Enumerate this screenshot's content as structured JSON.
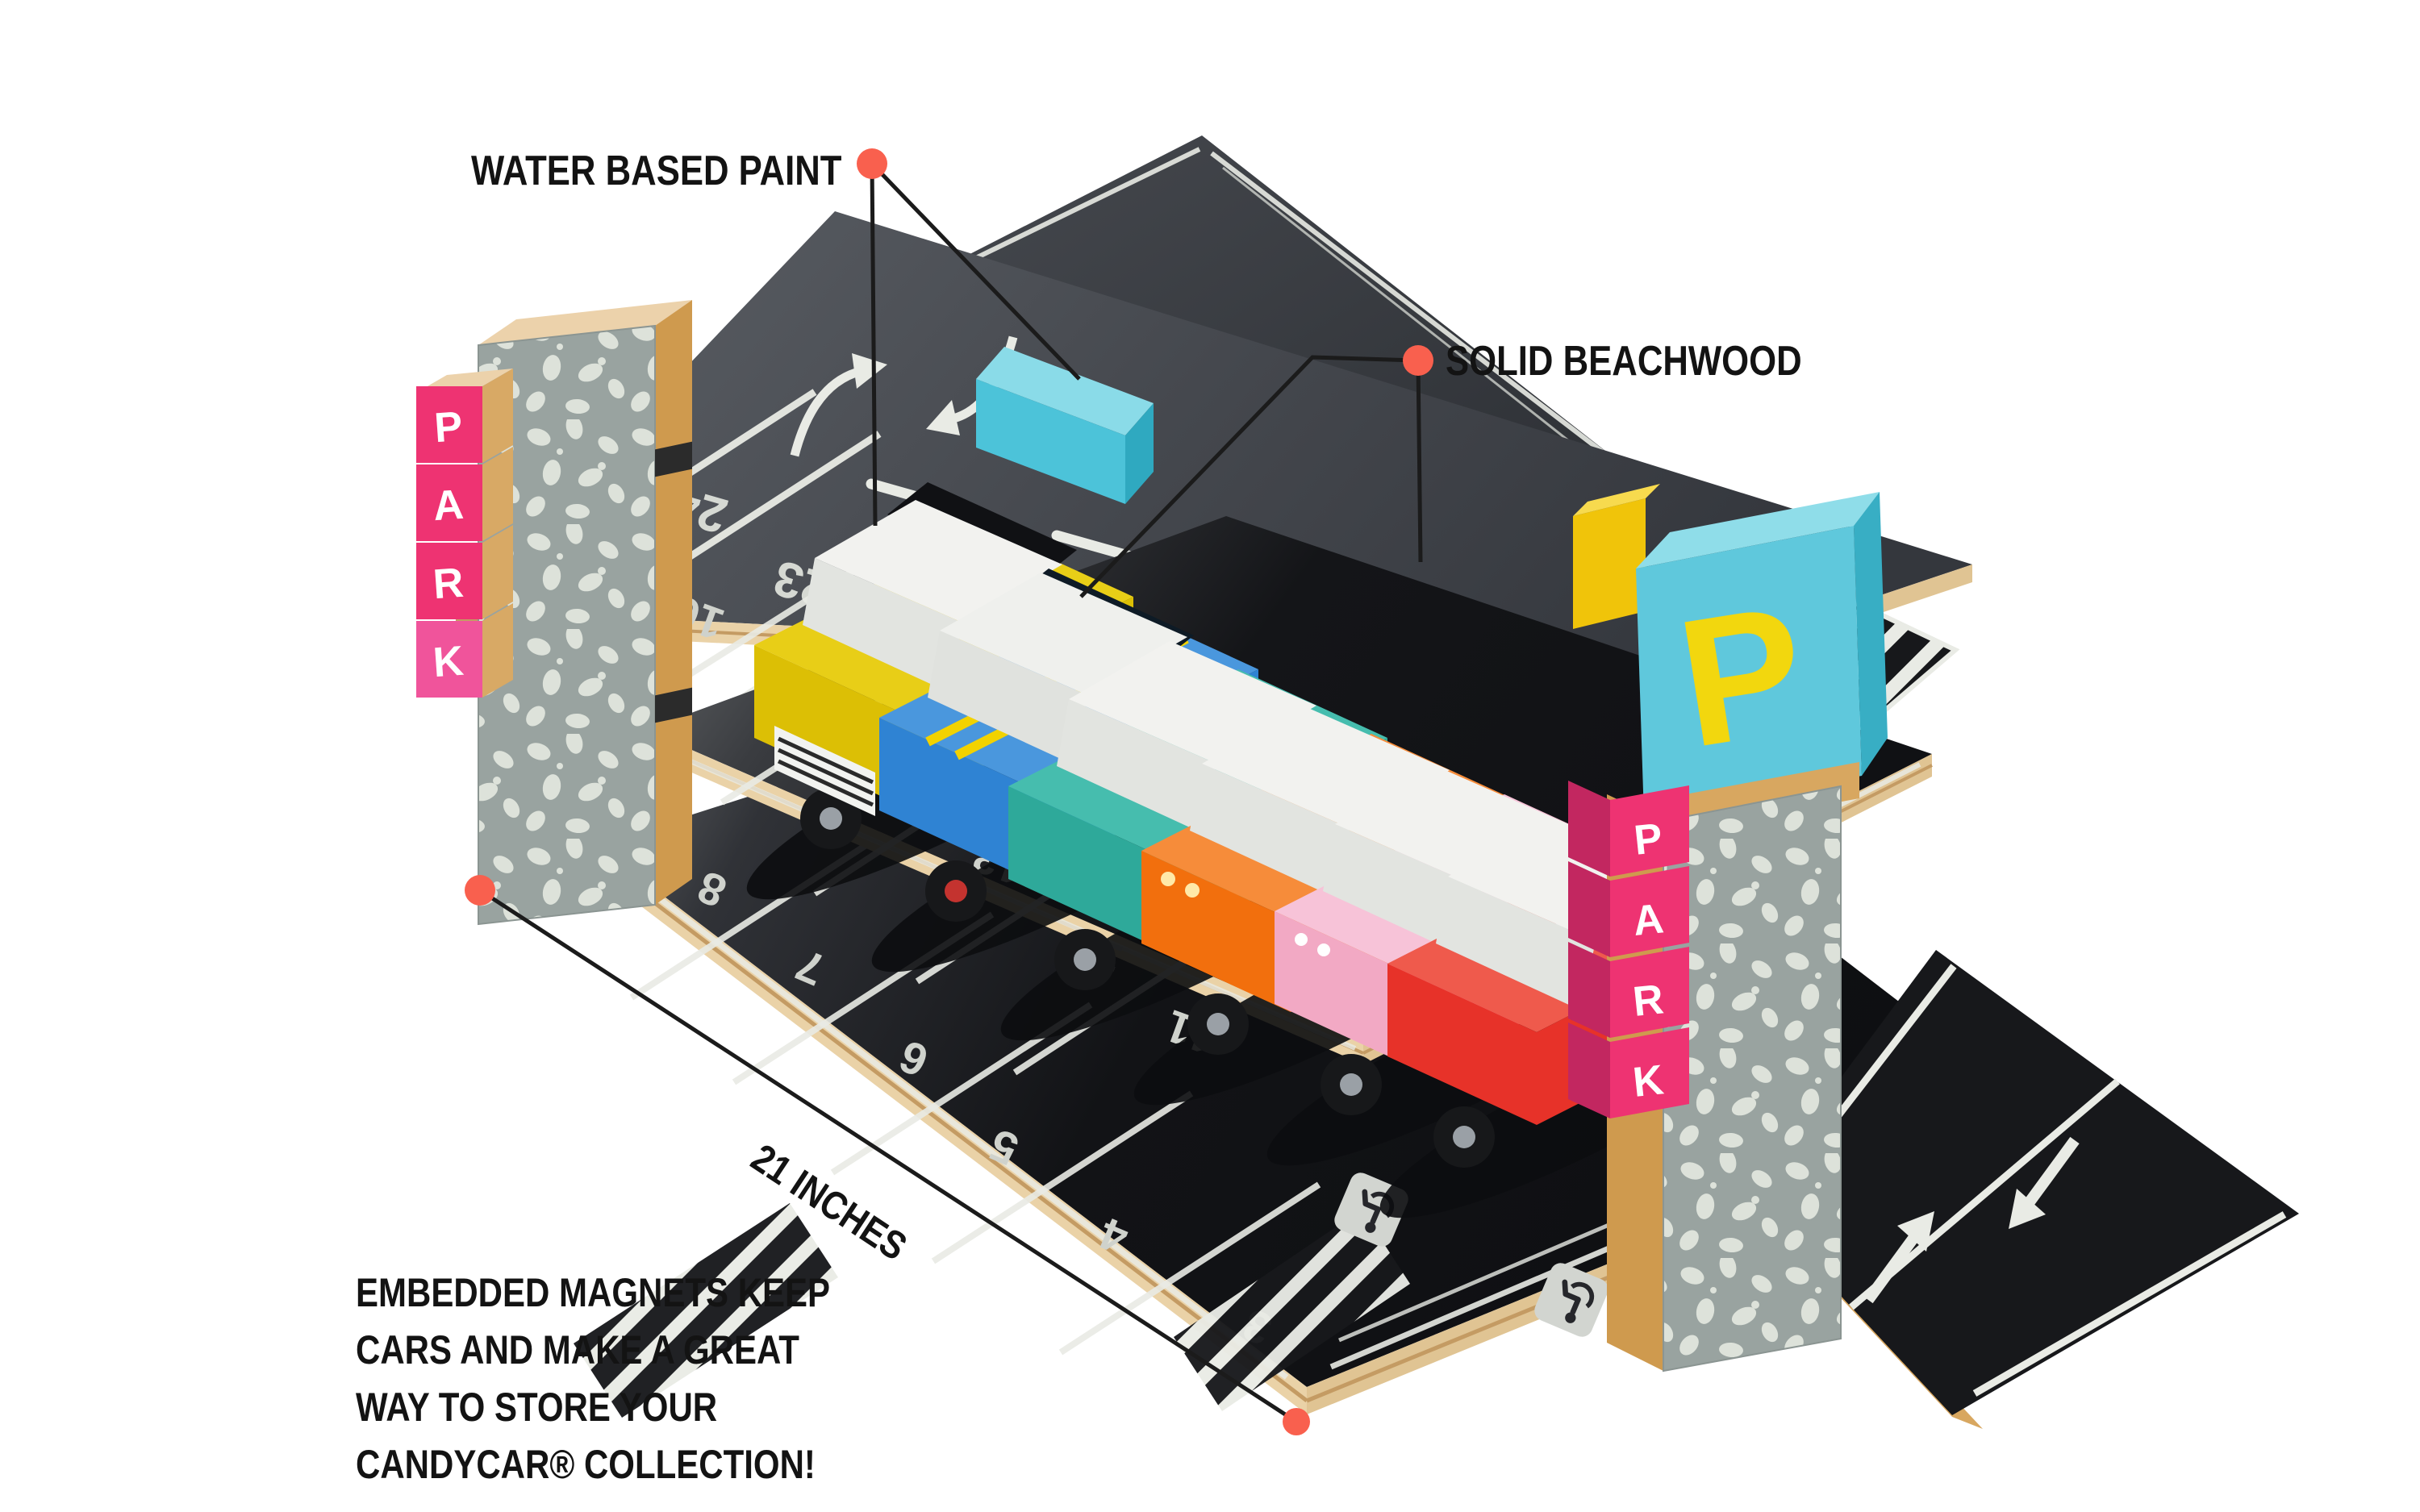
{
  "annotations": {
    "water_based_paint": "WATER BASED PAINT",
    "solid_beachwood": "SOLID BEACHWOOD",
    "dimension": "21 INCHES",
    "blurb_lines": [
      "EMBEDDED MAGNETS KEEP",
      "CARS AND MAKE A GREAT",
      "WAY TO STORE YOUR",
      "CANDYCAR® COLLECTION!"
    ]
  },
  "colors": {
    "accent_dot": "#F9604E",
    "leader_line": "#1b1b1b",
    "park_block_pink": "#EE3372",
    "sign_cyan": "#5FC8DC",
    "sign_letter_yellow": "#F2D70E",
    "road_marking_white": "#E9EBE5",
    "plywood": "#EAD2A7",
    "terrazzo_gray": "#99A3A0"
  },
  "icons": {
    "accessible_parking": "wheelchair-icon",
    "callout_marker": "dot-icon",
    "lane_arrows": [
      "arrow-up-icon",
      "arrow-down-icon"
    ],
    "turn_arrows": [
      "curved-arrow-icon",
      "curved-arrow-icon"
    ]
  },
  "garage": {
    "left_sign_letters": [
      "P",
      "A",
      "R",
      "K"
    ],
    "right_sign_letters": [
      "P",
      "A",
      "R",
      "K"
    ],
    "p_sign_letter": "P",
    "decks": {
      "top_numbers": [
        "24",
        "23"
      ],
      "middle_numbers": [
        "16",
        "15",
        "14",
        "13",
        "12",
        "11",
        "10",
        "9"
      ],
      "bottom_numbers": [
        "8",
        "7",
        "6",
        "5",
        "4",
        "3"
      ]
    },
    "cars": [
      {
        "name": "yellow-taxi",
        "color": "#DCBF05"
      },
      {
        "name": "blue-sedan",
        "color": "#2F83D3"
      },
      {
        "name": "teal-wagon",
        "color": "#2EA99A"
      },
      {
        "name": "orange-van",
        "color": "#F26F0D"
      },
      {
        "name": "pink-car",
        "color": "#F2A9C4"
      },
      {
        "name": "red-racer",
        "color": "#E73229",
        "number": "5"
      }
    ]
  }
}
